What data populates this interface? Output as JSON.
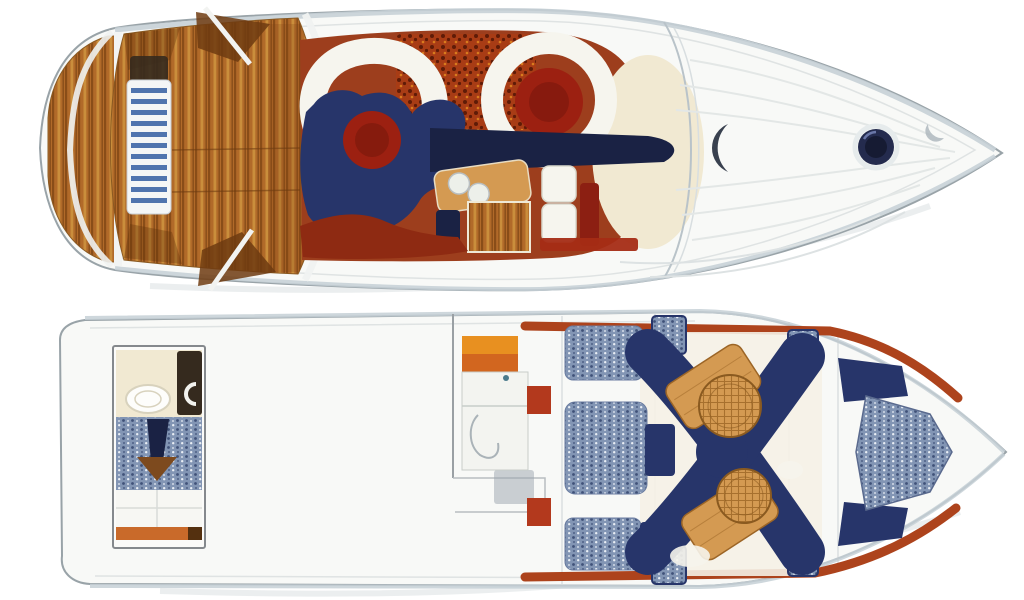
{
  "image": {
    "kind": "motor-yacht-floorplan",
    "background": "#ffffff"
  },
  "colors": {
    "hull_fill": "#f8f9f7",
    "hull_stroke": "#99a3a8",
    "hull_band": "#c6d0d6",
    "hull_inner": "#dfe3e3",
    "teak": "#b16a29",
    "teak_light": "#cf9440",
    "teak_dark": "#7c4212",
    "teak_deep": "#5f3009",
    "cockpit_floor": "#9d3e1d",
    "grill_base": "#a83c15",
    "grill_dot": "#5c1a06",
    "navy": "#27356a",
    "navy_dark": "#1a2244",
    "table_red": "#9c2011",
    "table_red_dark": "#6f150a",
    "cream": "#f1e9d2",
    "seat_white": "#f6f5ee",
    "upholstery_base": "#8295b4",
    "upholstery_dot_dark": "#3f5178",
    "upholstery_dot_light": "#e9eef5",
    "wood_tan": "#d49a52",
    "wood_tan_dark": "#9c6526",
    "orange_trim": "#d2661f",
    "orange_bright": "#e89020",
    "trim_red": "#ad431c",
    "ladder_white": "#f4f6f6",
    "ladder_blue": "#4f74ae",
    "accent_red_block": "#b3391d",
    "bench_red": "#8e2a12",
    "console_red": "#8c1f12",
    "hatch_navy": "#242b4e",
    "dark_fixture": "#352a1e",
    "arrow_brown": "#7d4a1e"
  },
  "decks": {
    "upper": {
      "role": "main-deck-plan"
    },
    "lower": {
      "role": "lower-deck-plan"
    }
  }
}
